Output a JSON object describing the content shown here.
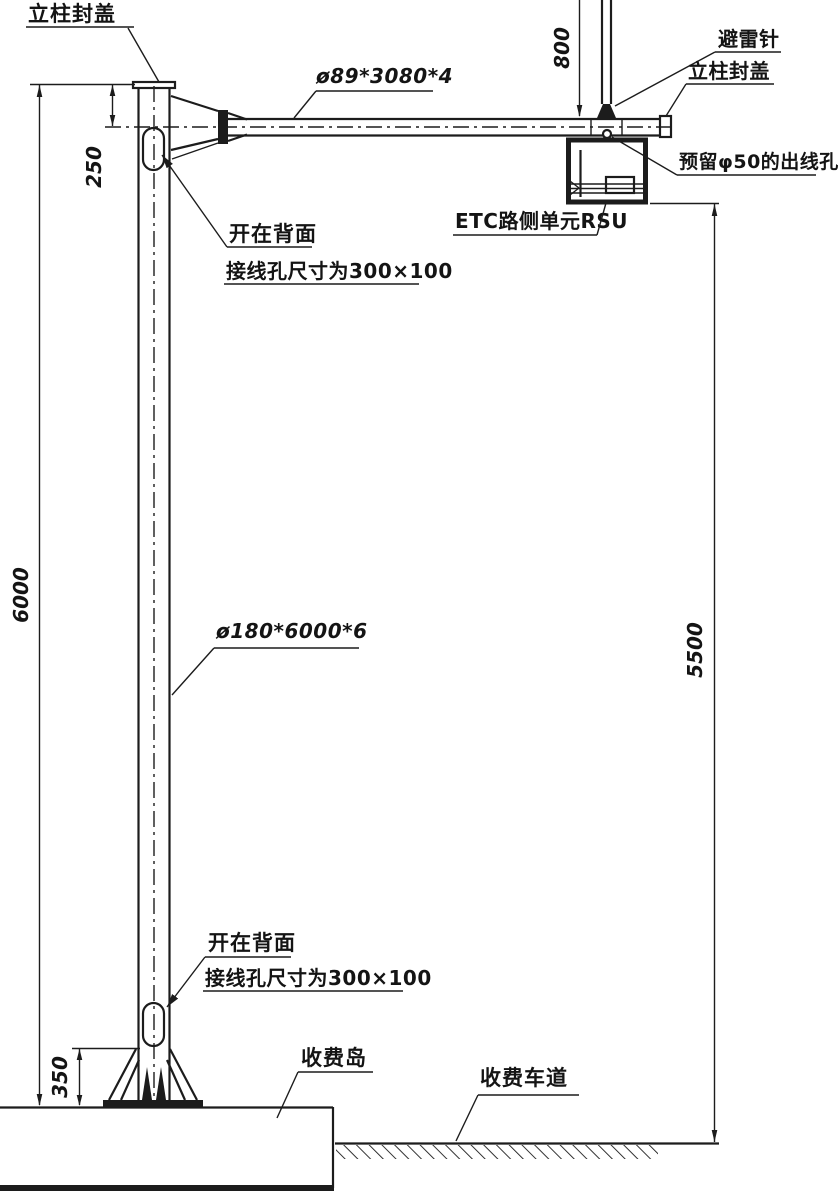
{
  "labels": {
    "pole_cap_left": "立柱封盖",
    "arm_spec": "ø89*3080*4",
    "lightning_rod": "避雷针",
    "pole_cap_right": "立柱封盖",
    "outlet_hole": "预留φ50的出线孔",
    "rsu_unit": "ETC路侧单元RSU",
    "hole_note_line1": "开在背面",
    "hole_note_line2": "接线孔尺寸为300×100",
    "pole_spec": "ø180*6000*6",
    "toll_island": "收费岛",
    "toll_lane": "收费车道"
  },
  "dimensions": {
    "pole_height": "6000",
    "arm_top_offset": "250",
    "rod_height": "800",
    "mount_clearance": "5500",
    "hole_bottom_offset": "350"
  },
  "colors": {
    "ink": "#1c1c1c",
    "background": "#ffffff"
  }
}
